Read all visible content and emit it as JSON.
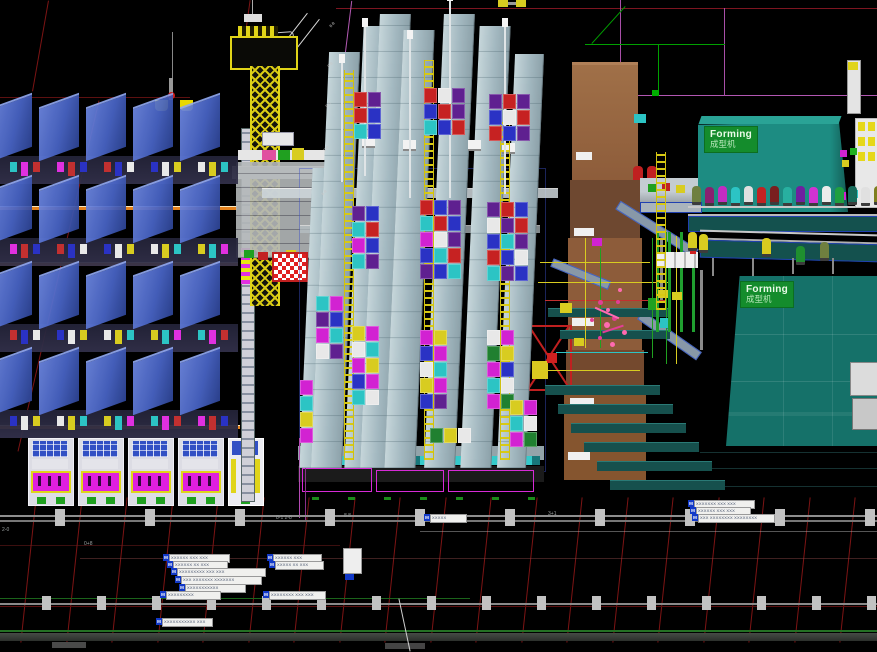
{
  "forming_machines": [
    {
      "label": "Forming",
      "sublabel": "成型机"
    },
    {
      "label": "Forming",
      "sublabel": "成型机"
    }
  ],
  "notes": {
    "top_note": "Cle=W"
  },
  "palette": {
    "background": "#000000",
    "grid_red": "#7d1414",
    "grid_magenta": "#b257b2",
    "green_line": "#247024",
    "wall_gray": "#8e8e8e",
    "column_gray": "#c2c2c2",
    "machine_blue": "#4a66c8",
    "rack_gray": "#a9bec6",
    "orange": "#e5821c",
    "carton_brown": "#8d5c3a",
    "forming_teal": "#1d8c82",
    "label_green": "#148c2c",
    "steps_teal": "#16504d",
    "cyan_strip": "#35caca",
    "magenta": "#df1fdf",
    "yellow": "#e0d41a"
  },
  "annotations": [
    {
      "x": 163,
      "y": 554,
      "w": 58,
      "icon": "M",
      "text": "XXXXXX XXX XXX"
    },
    {
      "x": 167,
      "y": 561,
      "w": 52,
      "icon": "M",
      "text": "XXXXXX XX XXX"
    },
    {
      "x": 171,
      "y": 568,
      "w": 86,
      "icon": "M",
      "text": "XXXXXXXXX XXX XXX"
    },
    {
      "x": 175,
      "y": 576,
      "w": 78,
      "icon": "M",
      "text": "XXX XXXXXXX XXXXXXX"
    },
    {
      "x": 179,
      "y": 584,
      "w": 58,
      "icon": "M",
      "text": "XXXXXXXXXXX"
    },
    {
      "x": 160,
      "y": 591,
      "w": 52,
      "icon": "M",
      "text": "XXXXXXXXX"
    },
    {
      "x": 267,
      "y": 554,
      "w": 46,
      "icon": "M",
      "text": "XXXXXX XXX"
    },
    {
      "x": 269,
      "y": 561,
      "w": 46,
      "icon": "M",
      "text": "XXXXX XX XXX"
    },
    {
      "x": 263,
      "y": 591,
      "w": 54,
      "icon": "M",
      "text": "XXXXXXXX XXX XXX"
    },
    {
      "x": 688,
      "y": 500,
      "w": 58,
      "icon": "M",
      "text": "XXXXXXX XXX XXX"
    },
    {
      "x": 690,
      "y": 507,
      "w": 52,
      "icon": "M",
      "text": "XXXXXX XXX XXX"
    },
    {
      "x": 692,
      "y": 514,
      "w": 74,
      "icon": "M",
      "text": "XXX XXXXXXXX XXXXXXXX"
    },
    {
      "x": 424,
      "y": 514,
      "w": 34,
      "icon": "M",
      "text": "XXXXX"
    },
    {
      "x": 156,
      "y": 618,
      "w": 48,
      "icon": "M",
      "text": "XXXXXXXXXXX XXX"
    }
  ],
  "ruler_ticks": [
    {
      "x": 2,
      "y": 527,
      "text": "2-0"
    },
    {
      "x": 84,
      "y": 541,
      "text": "0+8"
    },
    {
      "x": 276,
      "y": 515,
      "text": "8-1 2-8"
    },
    {
      "x": 344,
      "y": 513,
      "text": "8 8"
    },
    {
      "x": 548,
      "y": 511,
      "text": "3+1"
    }
  ],
  "dim_ticks": [
    {
      "x": 329,
      "y": 22,
      "text": "8-8"
    },
    {
      "x": 327,
      "y": 62,
      "text": "0-8"
    },
    {
      "x": 325,
      "y": 102,
      "text": "8-0"
    },
    {
      "x": 323,
      "y": 146,
      "text": "0-8"
    },
    {
      "x": 321,
      "y": 190,
      "text": "8-8"
    }
  ],
  "decor": {
    "red_grid": {
      "x0": 28,
      "step": 45.5,
      "count": 19,
      "y": 497,
      "h": 146,
      "tilt": 6
    },
    "red_diagonals": [
      {
        "x": 40,
        "y": 0,
        "h": 92,
        "tilt": 10
      },
      {
        "x": 58,
        "y": 96,
        "h": 360,
        "tilt": 13
      },
      {
        "x": 246,
        "y": 0,
        "h": 52,
        "tilt": 8
      }
    ],
    "wall_columns_a": {
      "x0": 55,
      "step": 90,
      "count": 10,
      "y": 509,
      "w": 10,
      "h": 17
    },
    "wall_columns_b": {
      "x0": 42,
      "step": 55,
      "count": 16,
      "y": 596,
      "w": 9,
      "h": 14
    },
    "machine_bands": {
      "x0": -8,
      "pitch": 47,
      "cols": 5,
      "ys": [
        100,
        182,
        268,
        354
      ],
      "top_w": 40,
      "top_h": 52,
      "internal_h": 28
    },
    "internal_dot_colors": [
      "#2cc4c4",
      "#e030e0",
      "#c23030",
      "#2a32c4",
      "#e8e8e8",
      "#d8cc20"
    ],
    "front_machines": {
      "x0": 28,
      "step": 50,
      "count": 4,
      "y": 438,
      "w": 44,
      "h": 66
    },
    "racks": [
      {
        "x": 306,
        "y": 168,
        "w": 30,
        "h": 300
      },
      {
        "x": 320,
        "y": 52,
        "w": 30,
        "h": 416
      },
      {
        "x": 354,
        "y": 26,
        "w": 30,
        "h": 442
      },
      {
        "x": 370,
        "y": 14,
        "w": 30,
        "h": 454
      },
      {
        "x": 394,
        "y": 30,
        "w": 30,
        "h": 438
      },
      {
        "x": 434,
        "y": 14,
        "w": 30,
        "h": 454
      },
      {
        "x": 470,
        "y": 26,
        "w": 30,
        "h": 442
      },
      {
        "x": 506,
        "y": 54,
        "w": 28,
        "h": 414
      }
    ],
    "masts": [
      {
        "x": 344,
        "y": 70,
        "h": 390
      },
      {
        "x": 424,
        "y": 60,
        "h": 400
      },
      {
        "x": 500,
        "y": 118,
        "h": 342
      },
      {
        "x": 656,
        "y": 152,
        "h": 158
      }
    ],
    "poles": [
      {
        "x": 341,
        "y": 62,
        "h": 120
      },
      {
        "x": 364,
        "y": 26,
        "h": 150
      },
      {
        "x": 409,
        "y": 38,
        "h": 160
      },
      {
        "x": 449,
        "y": 0,
        "h": 198
      },
      {
        "x": 504,
        "y": 26,
        "h": 168
      }
    ],
    "box_clusters": [
      {
        "x": 354,
        "y": 92,
        "cols": 2,
        "colors": [
          "#c62222",
          "#5f2090",
          "#c62222",
          "#2a32c4",
          "#2cc4c4",
          "#2a32c4"
        ]
      },
      {
        "x": 424,
        "y": 88,
        "cols": 3,
        "colors": [
          "#c62222",
          "#e8e8e8",
          "#5f2090",
          "#2a32c4",
          "#c62222",
          "#5f2090",
          "#2cc4c4",
          "#2a32c4",
          "#c62222"
        ]
      },
      {
        "x": 489,
        "y": 94,
        "cols": 3,
        "colors": [
          "#5f2090",
          "#c62222",
          "#5f2090",
          "#2a32c4",
          "#e8e8e8",
          "#c62222",
          "#c62222",
          "#2a32c4",
          "#5f2090"
        ]
      },
      {
        "x": 352,
        "y": 206,
        "cols": 2,
        "colors": [
          "#5f2090",
          "#2a32c4",
          "#2cc4c4",
          "#c62222",
          "#d222d2",
          "#2a32c4",
          "#2cc4c4",
          "#5f2090"
        ]
      },
      {
        "x": 420,
        "y": 200,
        "cols": 3,
        "colors": [
          "#c62222",
          "#2a32c4",
          "#5f2090",
          "#2cc4c4",
          "#c62222",
          "#2a32c4",
          "#d222d2",
          "#e8e8e8",
          "#5f2090",
          "#2a32c4",
          "#2cc4c4",
          "#c62222",
          "#5f2090",
          "#2a32c4",
          "#2cc4c4"
        ]
      },
      {
        "x": 487,
        "y": 202,
        "cols": 3,
        "colors": [
          "#5f2090",
          "#c62222",
          "#2a32c4",
          "#e8e8e8",
          "#5f2090",
          "#c62222",
          "#2a32c4",
          "#2cc4c4",
          "#5f2090",
          "#c62222",
          "#2a32c4",
          "#e8e8e8",
          "#2cc4c4",
          "#5f2090",
          "#2a32c4"
        ]
      },
      {
        "x": 316,
        "y": 296,
        "cols": 2,
        "colors": [
          "#2cc4c4",
          "#d222d2",
          "#5f2090",
          "#2a32c4",
          "#d222d2",
          "#2cc4c4",
          "#e8e8e8",
          "#5f2090"
        ]
      },
      {
        "x": 352,
        "y": 326,
        "cols": 2,
        "colors": [
          "#d8cc20",
          "#d222d2",
          "#e8e8e8",
          "#2cc4c4",
          "#d222d2",
          "#d8cc20",
          "#2a32c4",
          "#d222d2",
          "#2cc4c4",
          "#e8e8e8"
        ]
      },
      {
        "x": 420,
        "y": 330,
        "cols": 2,
        "colors": [
          "#d222d2",
          "#d8cc20",
          "#2a32c4",
          "#d222d2",
          "#e8e8e8",
          "#2cc4c4",
          "#d8cc20",
          "#d222d2",
          "#2a32c4",
          "#5f2090"
        ]
      },
      {
        "x": 487,
        "y": 330,
        "cols": 2,
        "colors": [
          "#e8e8e8",
          "#d222d2",
          "#208030",
          "#d8cc20",
          "#d222d2",
          "#2a32c4",
          "#2cc4c4",
          "#e8e8e8",
          "#d222d2",
          "#208030"
        ]
      },
      {
        "x": 300,
        "y": 380,
        "cols": 1,
        "colors": [
          "#d222d2",
          "#2cc4c4",
          "#d8cc20",
          "#d222d2"
        ]
      },
      {
        "x": 430,
        "y": 428,
        "cols": 3,
        "colors": [
          "#208030",
          "#d8cc20",
          "#e8e8e8"
        ]
      },
      {
        "x": 510,
        "y": 400,
        "cols": 2,
        "colors": [
          "#d8cc20",
          "#d222d2",
          "#2cc4c4",
          "#e8e8e8",
          "#d222d2",
          "#208030"
        ]
      }
    ],
    "bottle_row1": {
      "y": 186,
      "x0": 692,
      "step": 13,
      "colors": [
        "#6f7f3f",
        "#8a2070",
        "#c22cc2",
        "#2cc4c4",
        "#e0e0e0",
        "#c22222",
        "#7a1f1f",
        "#28b0a0",
        "#6f20a0",
        "#d232d2",
        "#ececec",
        "#1f9f3f",
        "#176a5a",
        "#e0e0e0",
        "#7f7f1f"
      ]
    },
    "bottle_row2": [
      {
        "x": 688,
        "y": 232,
        "c": "#d8cc20"
      },
      {
        "x": 699,
        "y": 234,
        "c": "#d8cc20"
      },
      {
        "x": 762,
        "y": 238,
        "c": "#d8cc20"
      },
      {
        "x": 796,
        "y": 246,
        "c": "#1f8f2f"
      },
      {
        "x": 820,
        "y": 242,
        "c": "#6f7f3f"
      }
    ],
    "steps": {
      "x0": 545,
      "y0": 385,
      "dx": 13,
      "dy": 19,
      "count": 6,
      "w": 115,
      "h": 9
    },
    "green_dashes": {
      "x0": 312,
      "step": 36,
      "count": 7,
      "y": 497,
      "w": 7,
      "h": 3
    },
    "rack_signs": [
      {
        "x": 362,
        "y": 137
      },
      {
        "x": 403,
        "y": 140
      },
      {
        "x": 468,
        "y": 140
      },
      {
        "x": 502,
        "y": 143
      }
    ]
  }
}
